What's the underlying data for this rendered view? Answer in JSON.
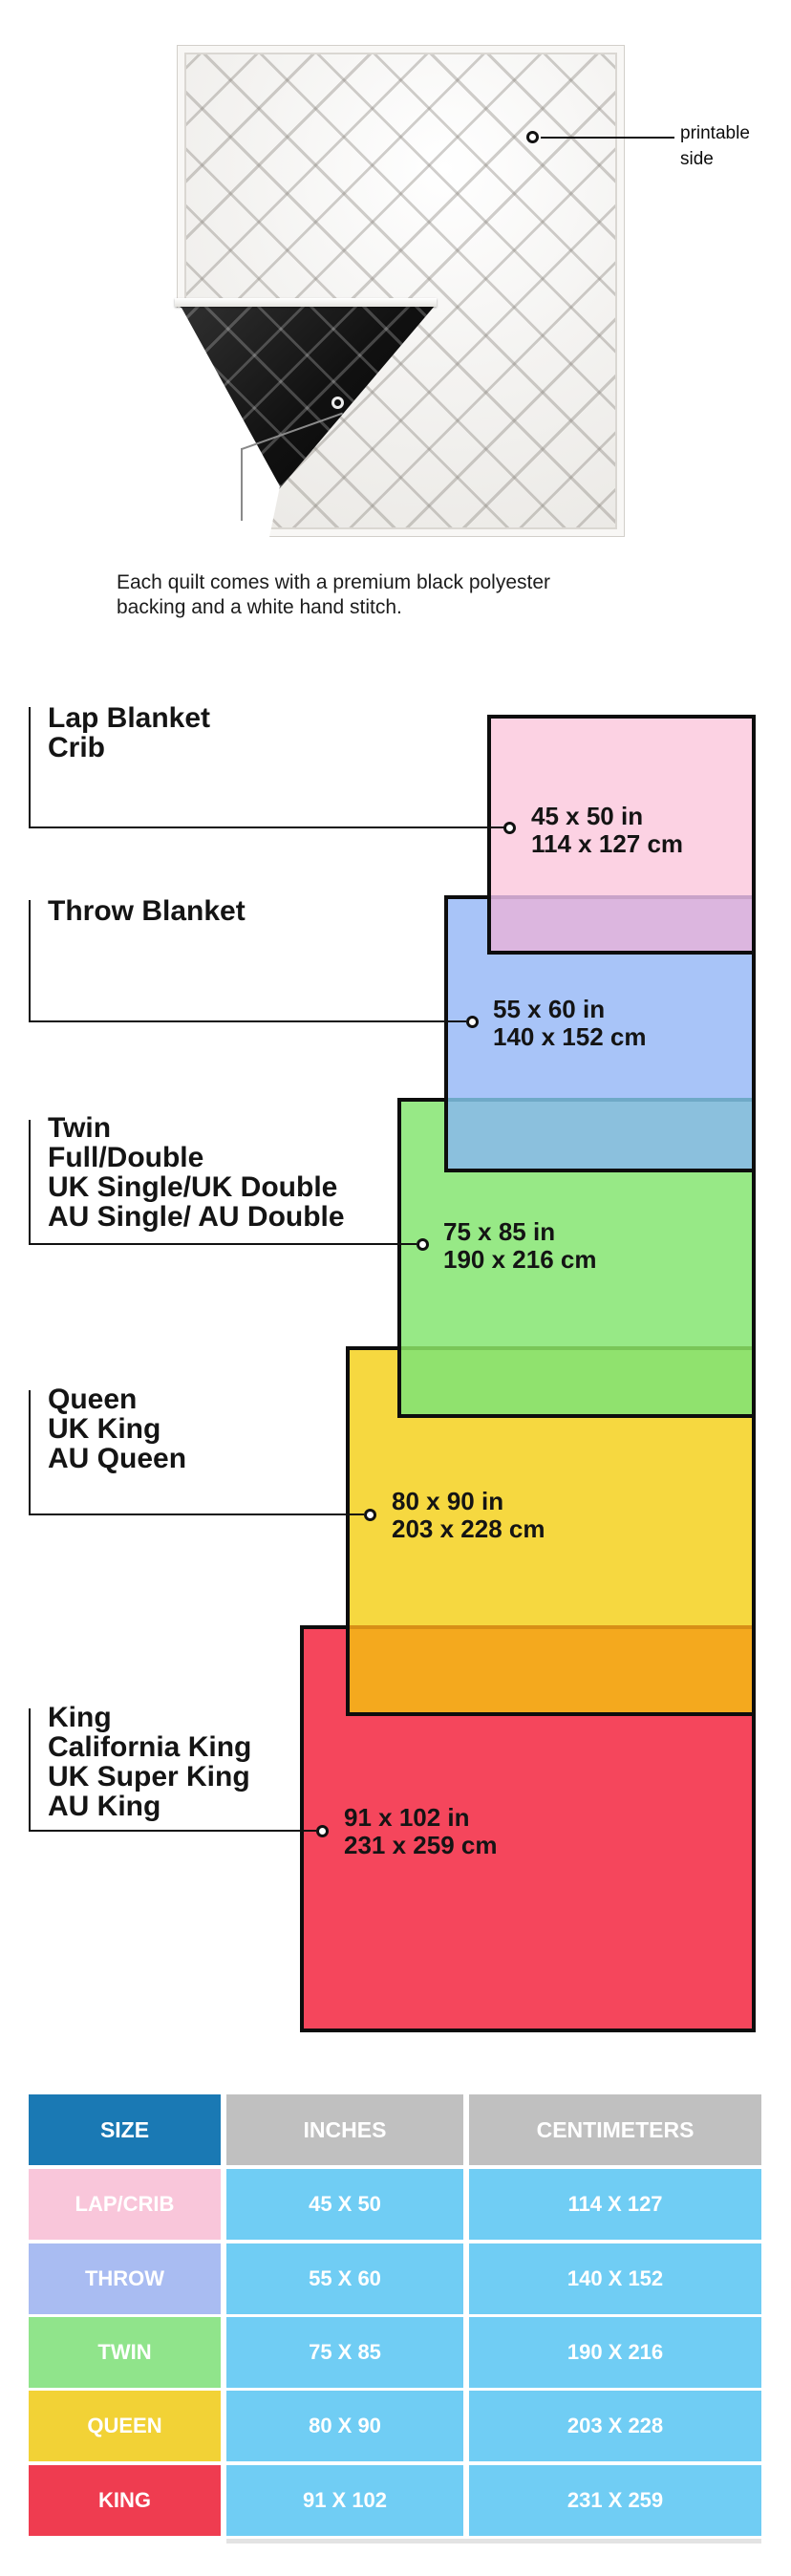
{
  "quilt": {
    "printable_label": [
      "printable",
      "side"
    ],
    "caption": [
      "Each quilt comes with a premium black polyester",
      "backing and a white hand stitch."
    ]
  },
  "diagram": {
    "sizes": [
      {
        "name": "lap-crib",
        "labels": [
          "Lap Blanket",
          "Crib"
        ],
        "inches": "45 x 50 in",
        "centimeters": "114 x 127 cm",
        "fill": "#fcd2e3"
      },
      {
        "name": "throw",
        "labels": [
          "Throw Blanket"
        ],
        "inches": "55 x 60 in",
        "centimeters": "140 x 152 cm",
        "fill": "#a8c4f8"
      },
      {
        "name": "twin",
        "labels": [
          "Twin",
          "Full/Double",
          "UK Single/UK Double",
          "AU Single/ AU Double"
        ],
        "inches": "75 x 85 in",
        "centimeters": "190 x 216 cm",
        "fill": "#97e986"
      },
      {
        "name": "queen",
        "labels": [
          "Queen",
          "UK King",
          "AU Queen"
        ],
        "inches": "80 x 90 in",
        "centimeters": "203 x 228 cm",
        "fill": "#f6d840"
      },
      {
        "name": "king",
        "labels": [
          "King",
          "California King",
          "UK Super King",
          "AU King"
        ],
        "inches": "91 x 102 in",
        "centimeters": "231 x 259 cm",
        "fill": "#f5465c"
      }
    ],
    "overlap_fills": {
      "pink_blue": "#dcb6df",
      "blue_green": "#8bc0dd",
      "green_yellow": "#90e26e",
      "yellow_red": "#f4a91e"
    }
  },
  "table": {
    "headers": [
      "SIZE",
      "INCHES",
      "CENTIMETERS"
    ],
    "header_colors": {
      "size": "#1a79b4",
      "other": "#c0c0c0"
    },
    "cell_color": "#70cdf4",
    "rows": [
      {
        "size": "LAP/CRIB",
        "inches": "45 X 50",
        "centimeters": "114 X 127",
        "color": "#f9c6da"
      },
      {
        "size": "THROW",
        "inches": "55 X 60",
        "centimeters": "140 X 152",
        "color": "#a9bcf2"
      },
      {
        "size": "TWIN",
        "inches": "75 X 85",
        "centimeters": "190 X 216",
        "color": "#90e48b"
      },
      {
        "size": "QUEEN",
        "inches": "80 X 90",
        "centimeters": "203 X 228",
        "color": "#f2d236"
      },
      {
        "size": "KING",
        "inches": "91 X 102",
        "centimeters": "231 X 259",
        "color": "#ef3c50"
      }
    ]
  }
}
